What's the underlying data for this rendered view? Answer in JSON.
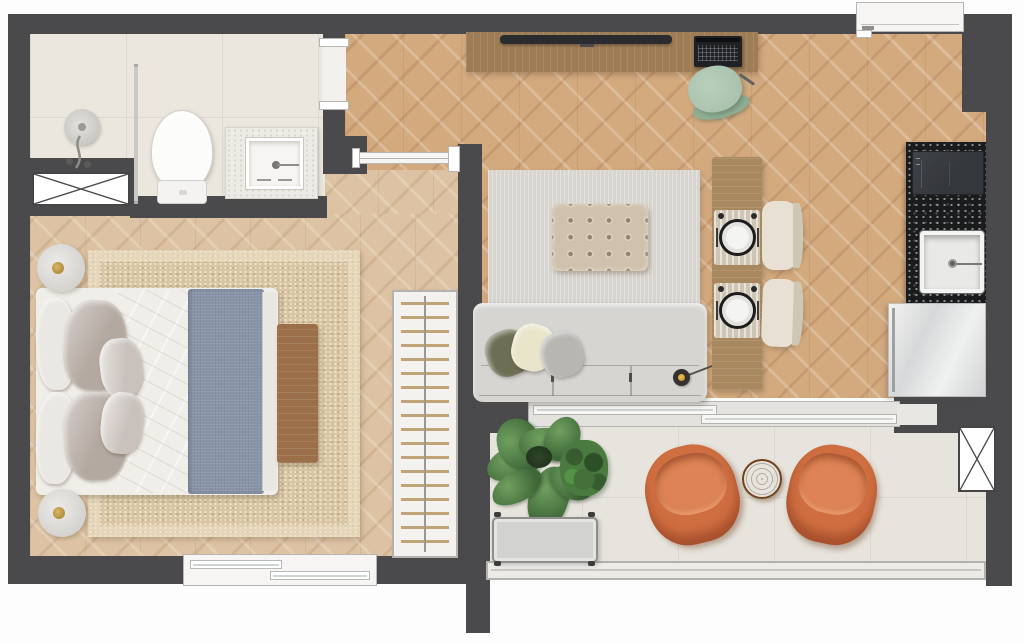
{
  "meta": {
    "type": "floor-plan",
    "view": "top-down",
    "text_labels_visible": false
  },
  "palette": {
    "wall": "#4a4a4c",
    "wood_bedroom": "#ddc3a3",
    "wood_living": "#d3a97e",
    "bath_tile": "#ebe7df",
    "balcony_tile": "#e7e4dd",
    "rug_beige": "#d9c5a2",
    "rug_gray": "#d8d5d0",
    "sofa_gray": "#d6d5d2",
    "ottoman_beige": "#cfc1ab",
    "blanket_blue": "#8995a8",
    "linen_white": "#f0eee9",
    "pillow_taupe": "#b4a9a1",
    "wood_desk": "#9e7c55",
    "wood_bench": "#9b6f4a",
    "wood_table": "#a8895f",
    "granite_black": "#1a1b1d",
    "chair_sage": "#a9c2ad",
    "armchair_orange": "#cf6e41",
    "table_round_wood": "#9c6433",
    "plant_green": "#4e7a45",
    "lamp_yellow": "#e8b33c",
    "door_white": "#f6f5f3",
    "cream_chair": "#e8e1d3",
    "fridge_steel": "#e3e4e5"
  },
  "rooms": [
    {
      "id": "bathroom",
      "label": "bathroom",
      "furniture": [
        "shower",
        "glass-partition",
        "toilet",
        "vanity-with-sink",
        "service-shaft"
      ]
    },
    {
      "id": "bedroom",
      "label": "bedroom",
      "furniture": [
        "double-bed",
        "six-pillows",
        "blue-throw-blanket",
        "beige-area-rug",
        "wood-foot-bench",
        "bedside-lamp-top",
        "bedside-lamp-bottom",
        "window"
      ]
    },
    {
      "id": "hall-closet",
      "label": "hall-with-open-closet",
      "furniture": [
        "open-wardrobe-with-hangers",
        "sliding-door-to-living"
      ],
      "hanger_rows": 19
    },
    {
      "id": "living-dining",
      "label": "living-dining-room",
      "furniture": [
        "media-sideboard-desk",
        "tv-soundbar",
        "laptop",
        "desk-chair-sage",
        "gray-area-rug",
        "tufted-ottoman",
        "three-seat-sofa",
        "sofa-pillows",
        "arc-floor-lamp-yellow",
        "dining-table",
        "two-place-settings",
        "two-dining-chairs"
      ]
    },
    {
      "id": "kitchen",
      "label": "kitchenette",
      "furniture": [
        "black-granite-counter",
        "cooktop",
        "square-sink",
        "refrigerator"
      ]
    },
    {
      "id": "balcony",
      "label": "balcony",
      "furniture": [
        "potted-plants",
        "planter-bench",
        "orange-lounge-chair-left",
        "orange-lounge-chair-right",
        "round-wood-side-table",
        "glass-railing",
        "service-shaft"
      ]
    }
  ],
  "openings": [
    "entry-door-top-right",
    "bathroom-doorway",
    "hall-sliding-door",
    "bedroom-window-bottom",
    "balcony-sliding-glass-door"
  ],
  "symbols": {
    "shaft_boxes": 2,
    "ottoman_tuft_grid": "5x4",
    "place_settings": 2,
    "sofa_seats": 3
  }
}
